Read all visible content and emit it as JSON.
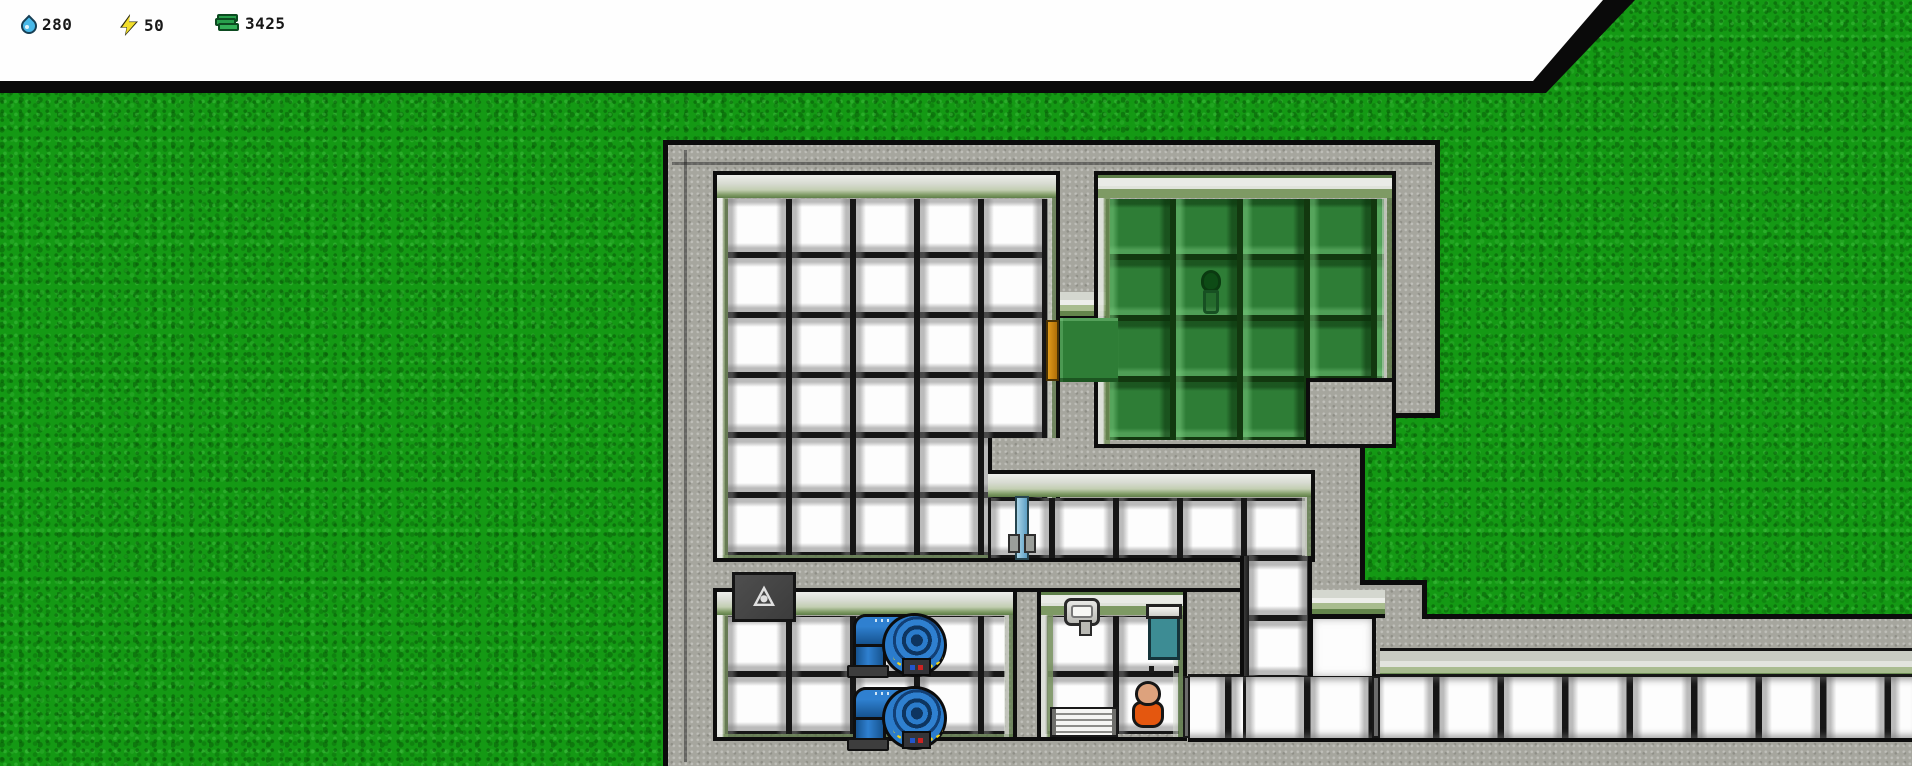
{
  "hud": {
    "resources": [
      {
        "name": "water",
        "icon": "water-drop-icon",
        "value": "280",
        "icon_color": "#49b9e9"
      },
      {
        "name": "power",
        "icon": "lightning-bolt-icon",
        "value": "50",
        "icon_color": "#f2de2c"
      },
      {
        "name": "money",
        "icon": "money-stack-icon",
        "value": "3425",
        "icon_color": "#28a04c"
      }
    ]
  },
  "palette": {
    "grass_green": "#149914",
    "wall_concrete": "#a6a69e",
    "outline_black": "#0d0d0d",
    "tile_white": "#fdfdfd",
    "garden_tile_green": "#2e7d36",
    "trim_green": "#7e9a64",
    "pipe_blue": "#2f80d0",
    "pump_stripe_yellow": "#f0d41c",
    "garden_door_orange": "#c8860f",
    "hall_door_blue": "#a8d4e8",
    "cabinet_teal": "#3d8c94",
    "worker_shirt_orange": "#e4570f"
  },
  "scene": {
    "ground": "grass-field",
    "rooms": [
      {
        "id": "large-tiled-room",
        "floor": "white-tile"
      },
      {
        "id": "garden-room",
        "floor": "green-tile",
        "contains": [
          "planter"
        ]
      },
      {
        "id": "hallway",
        "floor": "white-tile",
        "contains": [
          "blue-door"
        ]
      },
      {
        "id": "pump-room",
        "floor": "white-tile",
        "contains": [
          "water-pump",
          "water-pump",
          "wall-sign"
        ]
      },
      {
        "id": "utility-room",
        "floor": "white-tile",
        "contains": [
          "wall-sink",
          "storage-cabinet",
          "bench",
          "worker"
        ]
      },
      {
        "id": "south-corridor",
        "floor": "white-tile"
      }
    ]
  }
}
